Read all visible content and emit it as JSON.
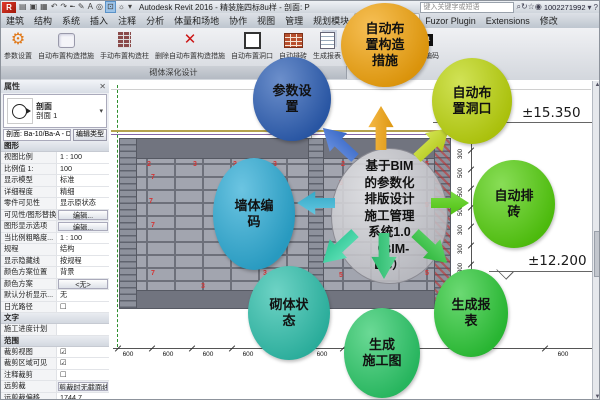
{
  "title_bar": {
    "app_title": "Autodesk Revit 2016 - 精装施四标8u样 - 剖面: P",
    "search_placeholder": "键入关键字或短语",
    "account": "1002271992",
    "qat_icons": [
      {
        "name": "open-icon",
        "glyph": "▤"
      },
      {
        "name": "save-icon",
        "glyph": "▣"
      },
      {
        "name": "print-icon",
        "glyph": "▦"
      },
      {
        "name": "undo-icon",
        "glyph": "↶"
      },
      {
        "name": "redo-icon",
        "glyph": "↷"
      },
      {
        "name": "measure-icon",
        "glyph": "╾"
      },
      {
        "name": "pencil-icon",
        "glyph": "✎"
      },
      {
        "name": "text-icon",
        "glyph": "A"
      },
      {
        "name": "3d-view-icon",
        "glyph": "◎"
      },
      {
        "name": "section-box-icon",
        "glyph": "⊡",
        "active": true
      },
      {
        "name": "sun-icon",
        "glyph": "☼"
      },
      {
        "name": "qat-menu-icon",
        "glyph": "▾"
      }
    ],
    "right_icons": [
      {
        "name": "search-icon",
        "glyph": "⌕"
      },
      {
        "name": "refresh-icon",
        "glyph": "↻"
      },
      {
        "name": "favorites-icon",
        "glyph": "☆"
      },
      {
        "name": "account-icon",
        "glyph": "◉"
      }
    ],
    "caret": "▾",
    "help": "?"
  },
  "ribbon": {
    "tabs": [
      "建筑",
      "结构",
      "系统",
      "插入",
      "注释",
      "分析",
      "体量和场地",
      "协作",
      "视图",
      "管理",
      "规划模块",
      "砌体深化设计",
      "Fuzor Plugin",
      "Extensions",
      "修改"
    ],
    "active_tab": "砌体深化设计",
    "panel_label": "砌体深化设计",
    "tools": [
      {
        "label": "参数设置",
        "icon": "gear",
        "glyph": "⚙"
      },
      {
        "label": "自动布置构造措施",
        "icon": "plate",
        "glyph": ""
      },
      {
        "label": "手动布置构造柱",
        "icon": "column",
        "glyph": ""
      },
      {
        "label": "删除自动布置构造措施",
        "icon": "delete",
        "glyph": "✕"
      },
      {
        "label": "自动布置洞口",
        "icon": "opening",
        "glyph": ""
      },
      {
        "label": "自动排砖",
        "icon": "bricks",
        "glyph": ""
      },
      {
        "label": "生成报表",
        "icon": "report",
        "glyph": ""
      },
      {
        "label": "生成施工图",
        "icon": "drawdoc",
        "glyph": ""
      },
      {
        "label": "",
        "icon": "wallgrid",
        "glyph": ""
      },
      {
        "label": "墙体编码",
        "icon": "t01",
        "glyph": "T01"
      }
    ]
  },
  "properties_panel": {
    "title": "属性",
    "close": "✕",
    "type_selector": {
      "category": "剖面",
      "type": "剖面 1",
      "dropdown": "▾"
    },
    "selector_row": {
      "selector": "剖面: Ba-10/Ba-A - D ∨",
      "edit_type": "编辑类型"
    },
    "sections": [
      {
        "header": "图形",
        "rows": [
          {
            "label": "视图比例",
            "value": "1 : 100"
          },
          {
            "label": "比例值 1:",
            "value": "100"
          },
          {
            "label": "显示模型",
            "value": "标准"
          },
          {
            "label": "详细程度",
            "value": "精细"
          },
          {
            "label": "零件可见性",
            "value": "显示原状态"
          },
          {
            "label": "可见性/图形替换",
            "value": "编辑...",
            "button": true
          },
          {
            "label": "图形显示选项",
            "value": "编辑...",
            "button": true
          },
          {
            "label": "当比例粗略度...",
            "value": "1 : 100"
          },
          {
            "label": "规程",
            "value": "结构"
          },
          {
            "label": "显示隐藏线",
            "value": "按规程"
          },
          {
            "label": "颜色方案位置",
            "value": "背景"
          },
          {
            "label": "颜色方案",
            "value": "<无>",
            "button": true
          },
          {
            "label": "默认分析显示...",
            "value": "无"
          },
          {
            "label": "日光路径",
            "value": "☐"
          }
        ]
      },
      {
        "header": "文字",
        "rows": [
          {
            "label": "施工进度计划",
            "value": ""
          }
        ]
      },
      {
        "header": "范围",
        "rows": [
          {
            "label": "裁剪视图",
            "value": "☑"
          },
          {
            "label": "裁剪区域可见",
            "value": "☑"
          },
          {
            "label": "注释裁剪",
            "value": "☐"
          },
          {
            "label": "远剪裁",
            "value": "剪裁时无截面线",
            "button": true
          },
          {
            "label": "远剪裁偏移",
            "value": "1744.7"
          },
          {
            "label": "范围框",
            "value": "无"
          }
        ]
      }
    ]
  },
  "drawing": {
    "levels": [
      {
        "label": "±15.350"
      },
      {
        "label": "±12.200"
      }
    ],
    "bottom_dims": [
      {
        "v": "600",
        "x": 127
      },
      {
        "v": "600",
        "x": 167
      },
      {
        "v": "600",
        "x": 207
      },
      {
        "v": "600",
        "x": 247
      },
      {
        "v": "600",
        "x": 287
      },
      {
        "v": "600",
        "x": 321
      },
      {
        "v": "510",
        "x": 349
      },
      {
        "v": "309",
        "x": 366
      },
      {
        "v": "250",
        "x": 383
      },
      {
        "v": "388",
        "x": 400
      },
      {
        "v": "600",
        "x": 562
      }
    ],
    "bottom_ticks": [
      113,
      147,
      187,
      227,
      267,
      304,
      338,
      358,
      374,
      391,
      409,
      540,
      590
    ],
    "right_dims": [
      "300",
      "500",
      "500",
      "500",
      "300",
      "300",
      "300",
      "300",
      "300",
      "300"
    ],
    "brick_numbers": [
      {
        "v": "2",
        "x": 146,
        "y": 160
      },
      {
        "v": "3",
        "x": 192,
        "y": 160
      },
      {
        "v": "2",
        "x": 232,
        "y": 160
      },
      {
        "v": "3",
        "x": 272,
        "y": 160
      },
      {
        "v": "2",
        "x": 340,
        "y": 160
      },
      {
        "v": "5",
        "x": 424,
        "y": 160
      },
      {
        "v": "7",
        "x": 150,
        "y": 173
      },
      {
        "v": "3",
        "x": 238,
        "y": 173
      },
      {
        "v": "1",
        "x": 282,
        "y": 177
      },
      {
        "v": "5",
        "x": 338,
        "y": 179
      },
      {
        "v": "7",
        "x": 148,
        "y": 197
      },
      {
        "v": "8",
        "x": 236,
        "y": 197
      },
      {
        "v": "3",
        "x": 262,
        "y": 201
      },
      {
        "v": "5",
        "x": 424,
        "y": 201
      },
      {
        "v": "7",
        "x": 150,
        "y": 221
      },
      {
        "v": "3",
        "x": 240,
        "y": 223
      },
      {
        "v": "8",
        "x": 236,
        "y": 245
      },
      {
        "v": "5",
        "x": 424,
        "y": 245
      },
      {
        "v": "7",
        "x": 150,
        "y": 269
      },
      {
        "v": "3",
        "x": 262,
        "y": 269
      },
      {
        "v": "5",
        "x": 338,
        "y": 271
      },
      {
        "v": "5",
        "x": 424,
        "y": 269
      },
      {
        "v": "5",
        "x": 300,
        "y": 282
      },
      {
        "v": "3",
        "x": 200,
        "y": 282
      }
    ]
  },
  "diagram": {
    "center": {
      "label": "基于BIM\n的参数化\n排版设计\n施工管理\n系统1.0\n（BIM-\nDC）"
    },
    "bubbles": [
      {
        "id": "measures",
        "label": "自动布\n置构造\n措施",
        "color": "#f3a40c"
      },
      {
        "id": "param",
        "label": "参数设\n置",
        "color": "#2d5fb5"
      },
      {
        "id": "openings",
        "label": "自动布\n置洞口",
        "color": "#bdd60d"
      },
      {
        "id": "autobrick",
        "label": "自动排\n砖",
        "color": "#55cf0e"
      },
      {
        "id": "wallcode",
        "label": "墙体编\n码",
        "color": "#2cabd5"
      },
      {
        "id": "state",
        "label": "砌体状\n态",
        "color": "#2fc0ac"
      },
      {
        "id": "shopdwg",
        "label": "生成\n施工图",
        "color": "#2bc968"
      },
      {
        "id": "report",
        "label": "生成报\n表",
        "color": "#2cc937"
      }
    ],
    "arrows": [
      {
        "id": "up",
        "color": "#f4a50e"
      },
      {
        "id": "upleft",
        "color": "#3a6fd8"
      },
      {
        "id": "upright",
        "color": "#c6dd1c"
      },
      {
        "id": "left",
        "color": "#35b8da"
      },
      {
        "id": "right",
        "color": "#53d30e"
      },
      {
        "id": "downleft",
        "color": "#2fd9a2"
      },
      {
        "id": "down",
        "color": "#29ca74"
      },
      {
        "id": "downright",
        "color": "#2fc93e"
      }
    ]
  },
  "colors": {
    "brick_fill": "#a2a5af",
    "brick_joint": "#6d707a",
    "beam": "#71747f",
    "dimension_text": "#111111",
    "brick_number_red": "#d23434",
    "grid_green": "#2e8f2e"
  }
}
